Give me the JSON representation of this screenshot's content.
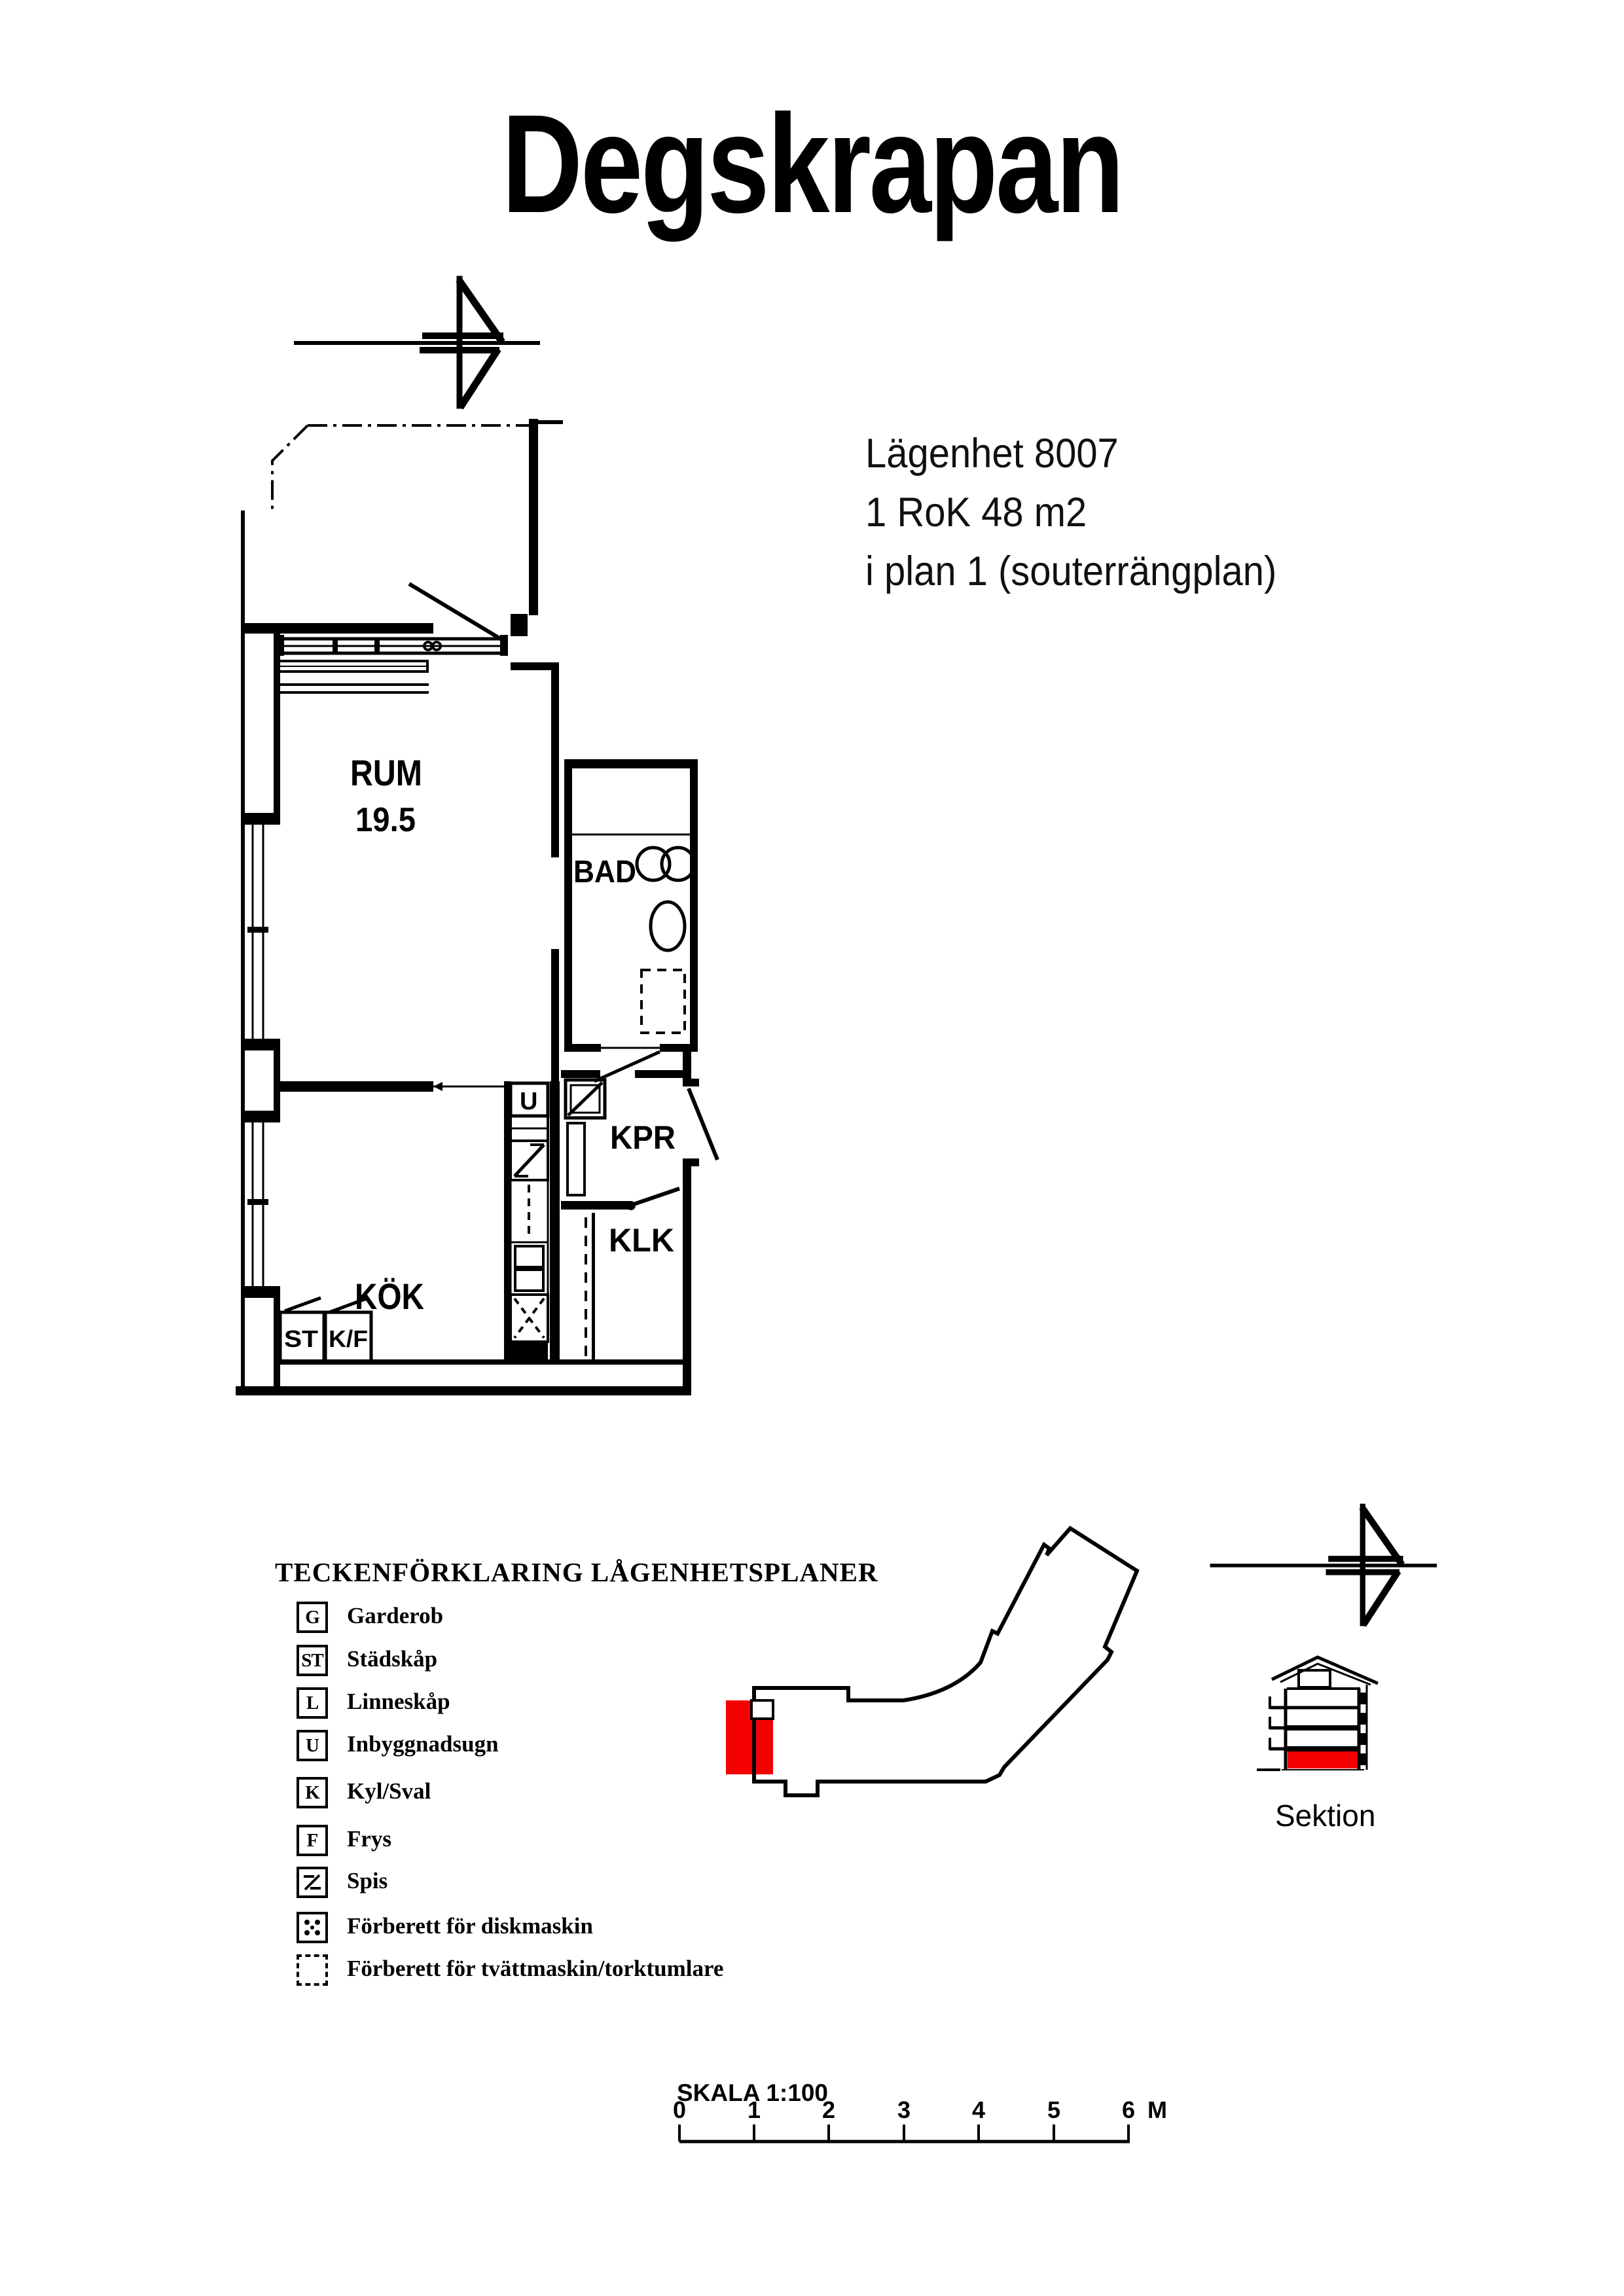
{
  "page": {
    "title": "Degskrapan"
  },
  "apartment": {
    "id_line": "Lägenhet 8007",
    "size_line": "1 RoK 48 m2",
    "floor_line": "i plan 1 (souterrängplan)"
  },
  "floor_plan": {
    "labels": {
      "rum": "RUM",
      "rum_area": "19.5",
      "bad": "BAD",
      "kok": "KÖK",
      "kpr": "KPR",
      "klk": "KLK",
      "st": "ST",
      "kf": "K/F",
      "ugn": "U"
    }
  },
  "legend": {
    "title": "TECKENFÖRKLARING LÅGENHETSPLANER",
    "items": [
      {
        "symbol": "G",
        "icon": "letter-box-icon",
        "label": "Garderob"
      },
      {
        "symbol": "ST",
        "icon": "letter-box-icon",
        "label": "Städskåp"
      },
      {
        "symbol": "L",
        "icon": "letter-box-icon",
        "label": "Linneskåp"
      },
      {
        "symbol": "U",
        "icon": "letter-box-icon",
        "label": "Inbyggnadsugn"
      },
      {
        "symbol": "K",
        "icon": "letter-box-icon",
        "label": "Kyl/Sval"
      },
      {
        "symbol": "F",
        "icon": "letter-box-icon",
        "label": "Frys"
      },
      {
        "symbol": "spis-icon",
        "icon": "spis-icon",
        "label": "Spis"
      },
      {
        "symbol": "diskmaskin-icon",
        "icon": "diskmaskin-icon",
        "label": "Förberett för diskmaskin"
      },
      {
        "symbol": "tvattmaskin-icon",
        "icon": "tvattmaskin-icon",
        "label": "Förberett för tvättmaskin/torktumlare"
      }
    ]
  },
  "section": {
    "label": "Sektion"
  },
  "scale": {
    "label": "SKALA 1:100",
    "ticks": [
      "0",
      "1",
      "2",
      "3",
      "4",
      "5",
      "6"
    ],
    "unit": "M"
  },
  "colors": {
    "highlight_red": "#f40000",
    "ink": "#000000"
  }
}
